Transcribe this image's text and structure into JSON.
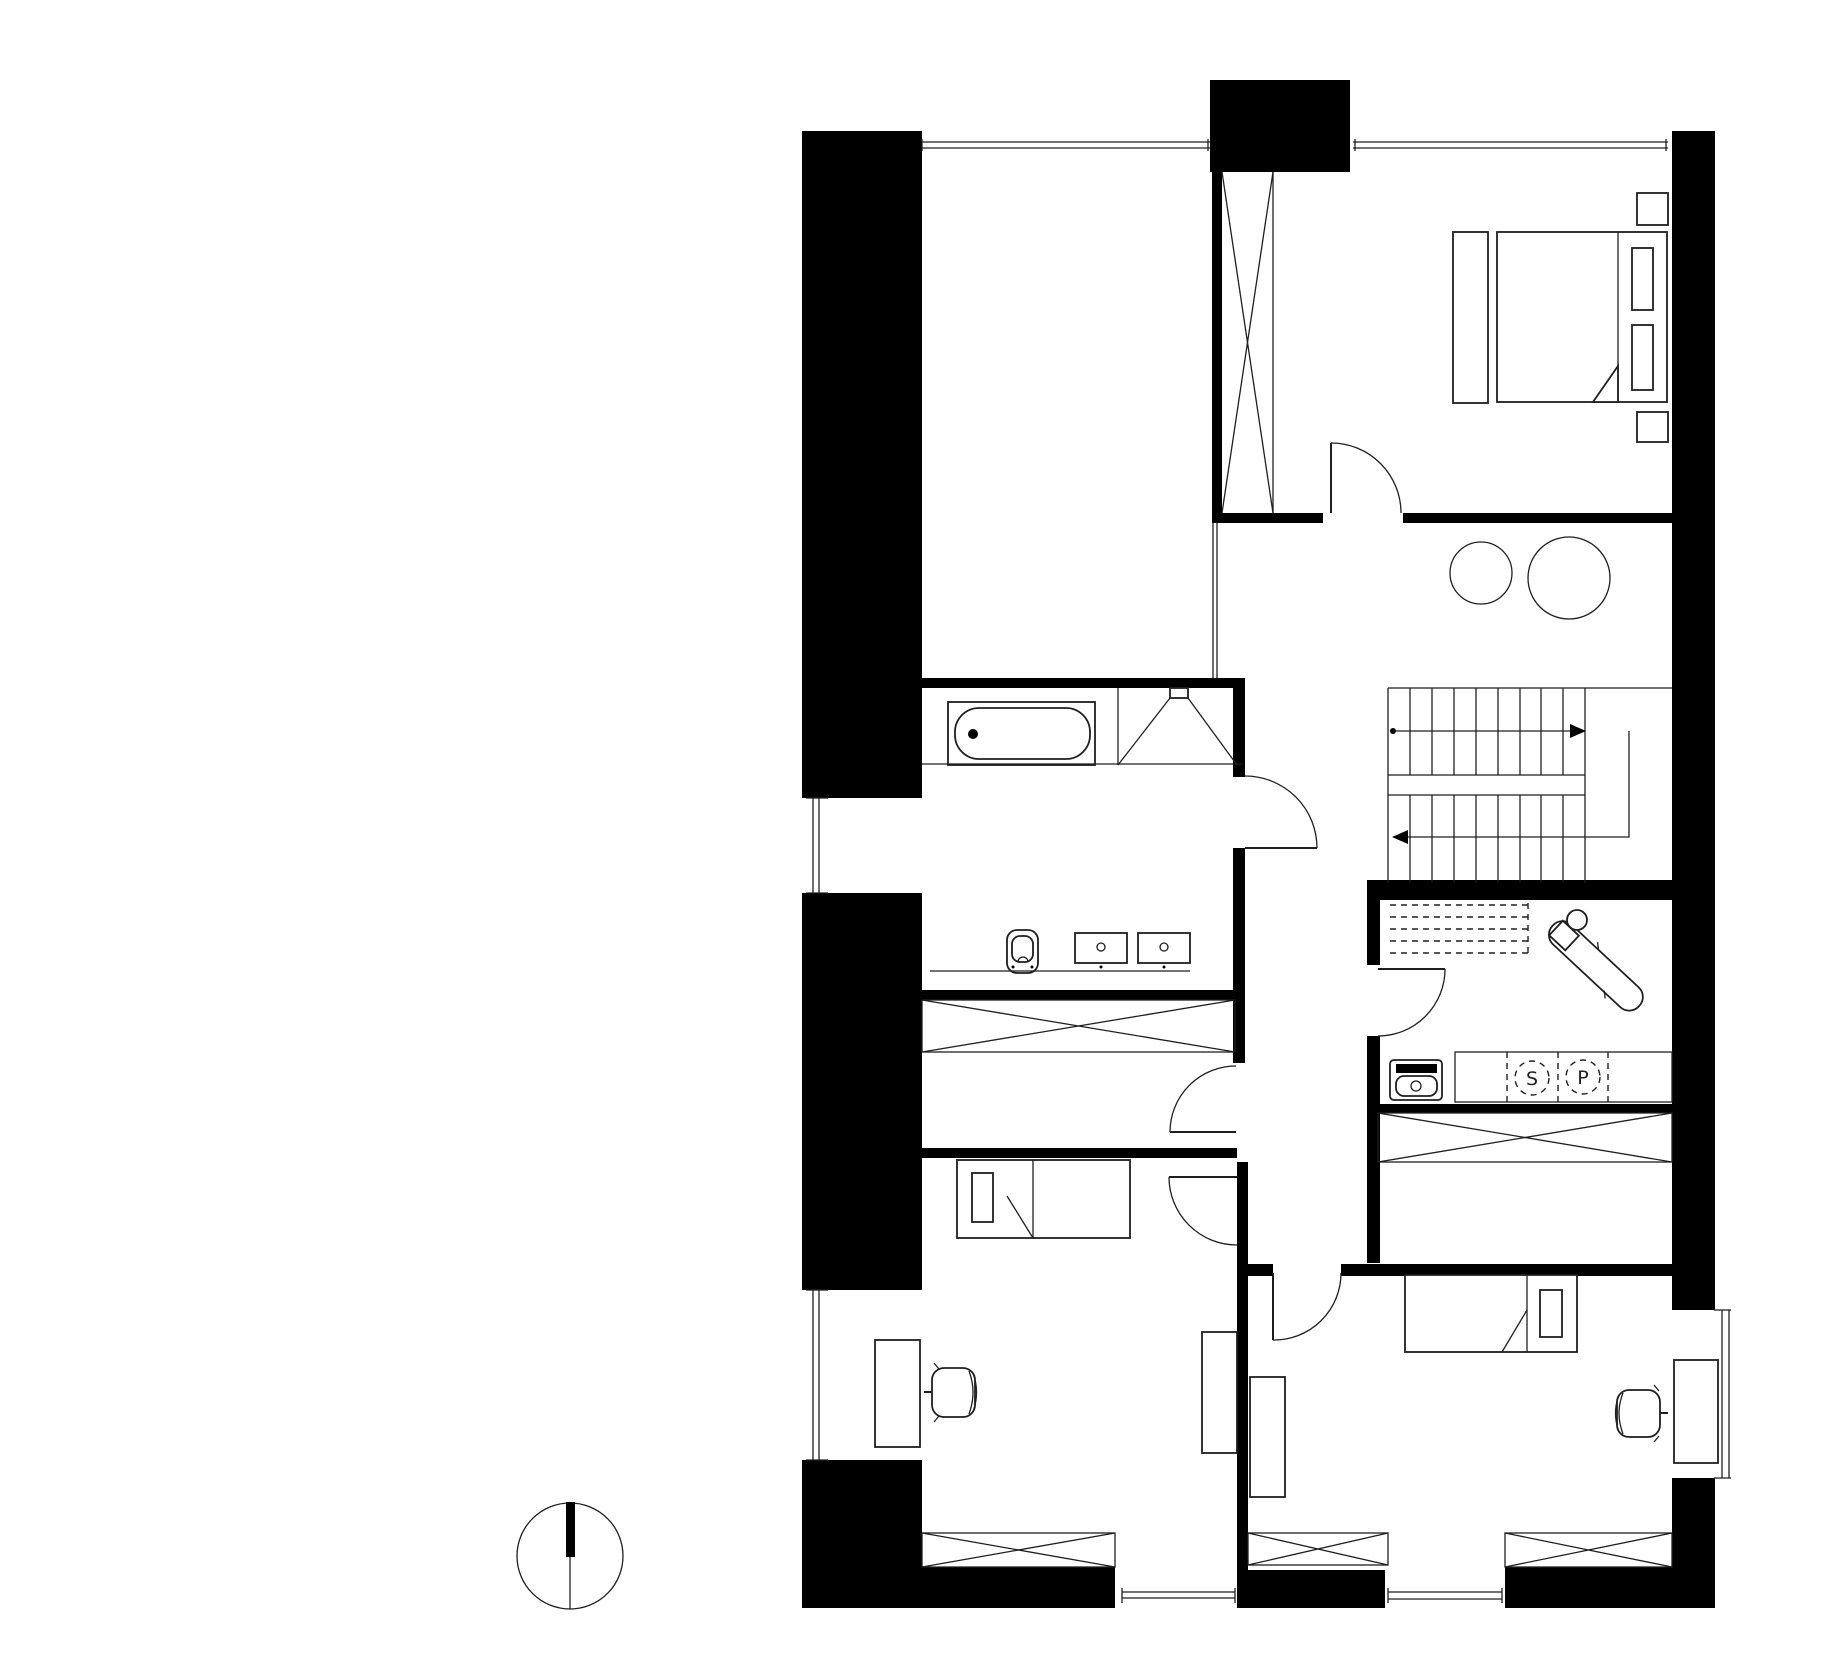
{
  "drawing": {
    "kind": "architectural-floor-plan",
    "level": "upper-floor",
    "style": "black-poche-walls-on-white"
  },
  "colors": {
    "wall": "#000000",
    "line": "#1f1f1f",
    "bg": "#ffffff"
  },
  "appliances": {
    "dryer_label": "S",
    "washer_label": "P"
  }
}
